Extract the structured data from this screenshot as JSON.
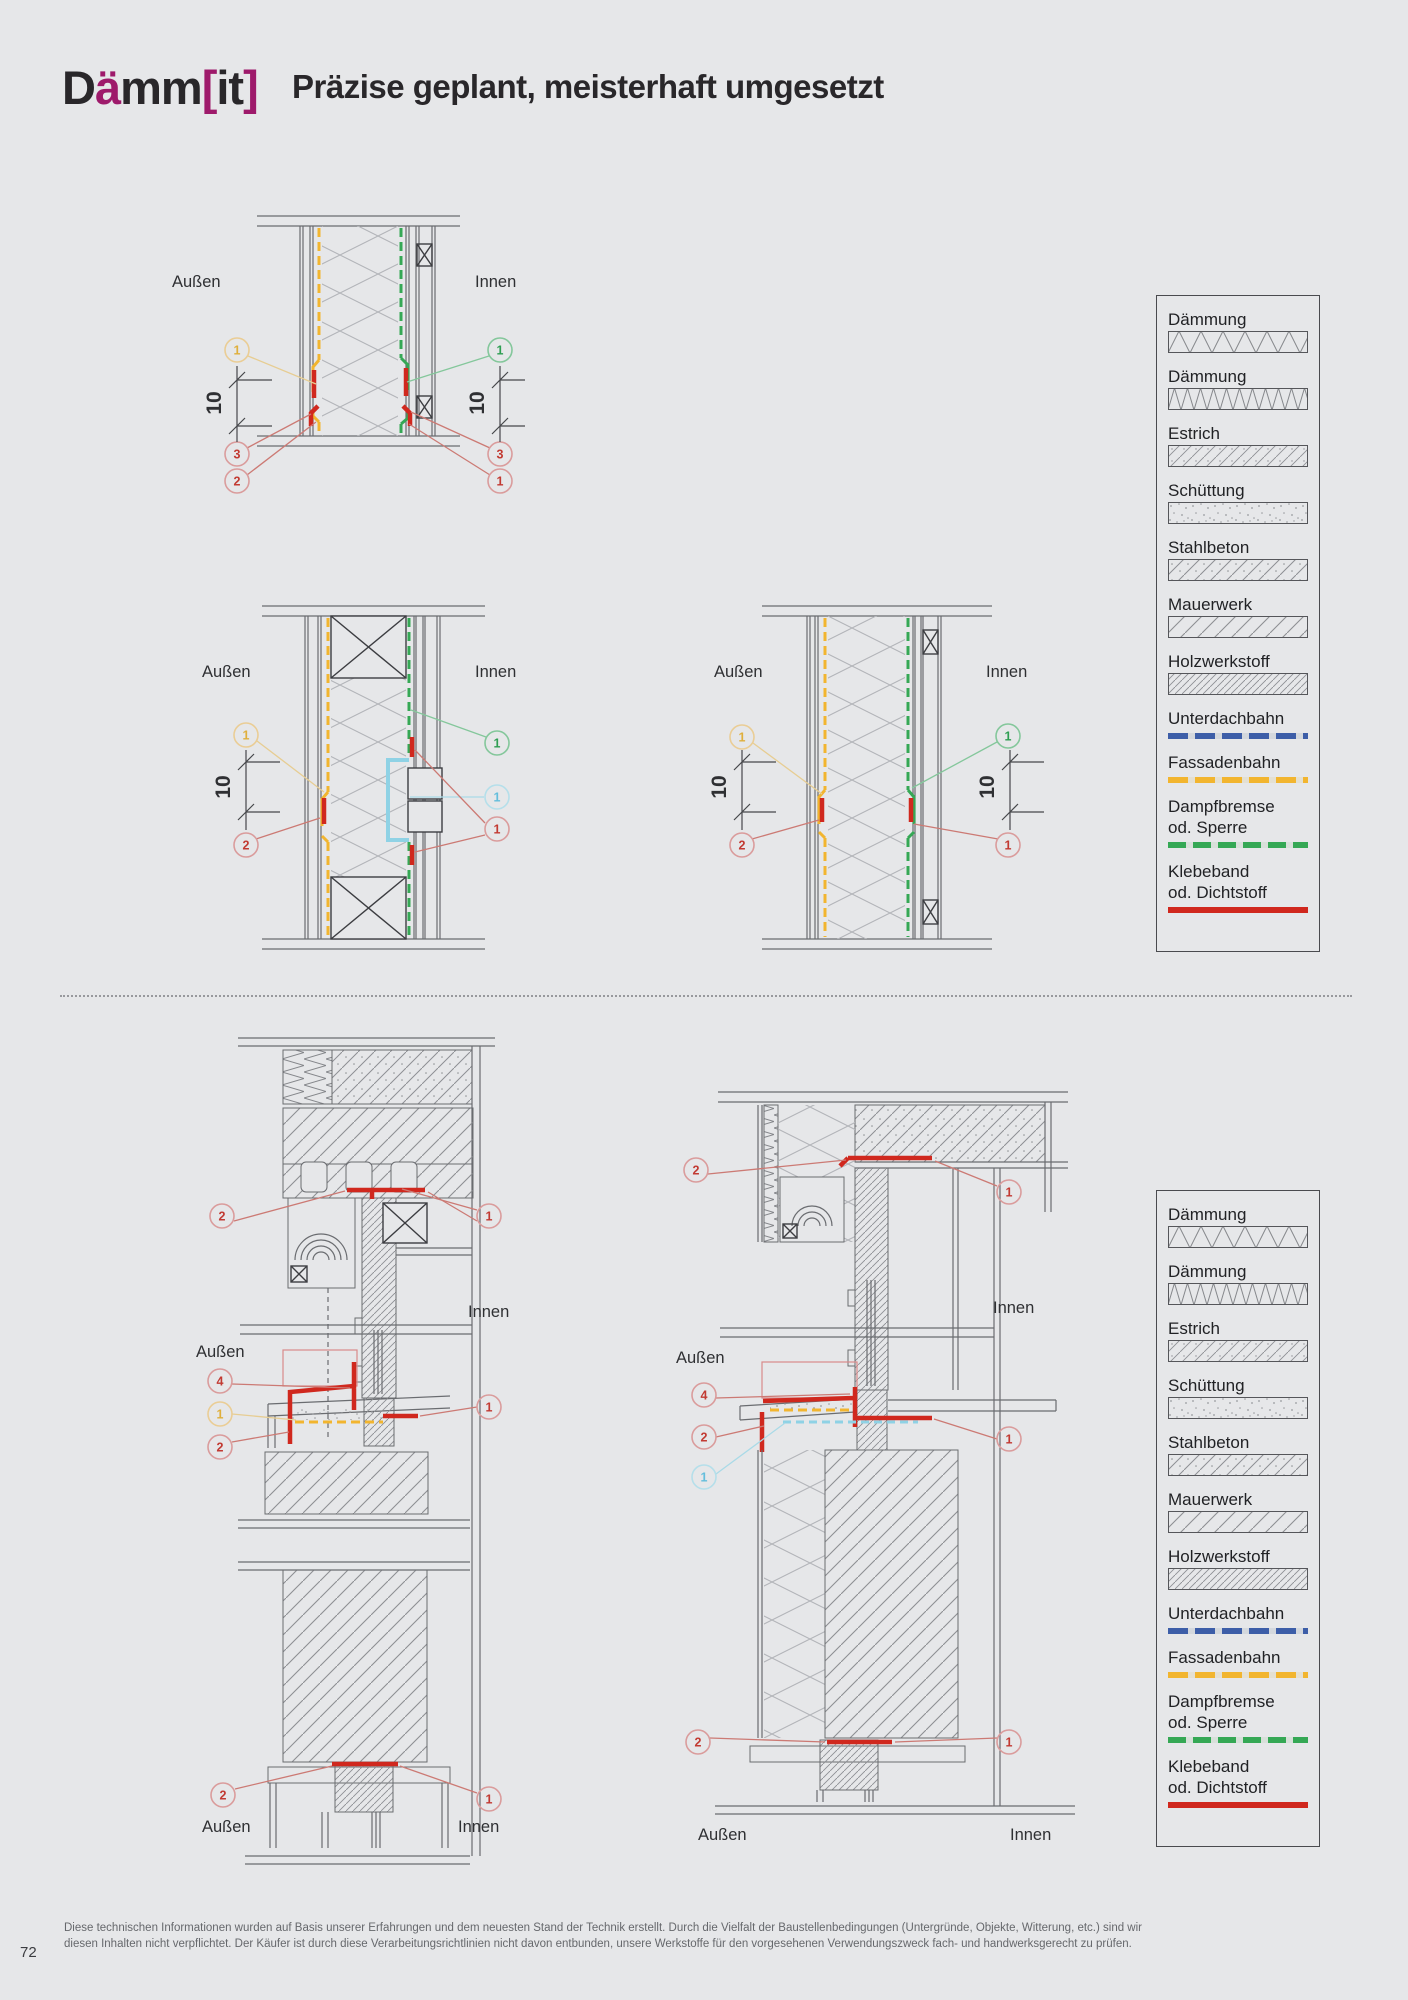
{
  "header": {
    "logo": {
      "d": "D",
      "auml": "ä",
      "mm": "mm",
      "bracket_open": "[",
      "it": "it",
      "bracket_close": "]"
    },
    "title": "Präzise geplant, meisterhaft umgesetzt"
  },
  "labels": {
    "aussen": "Außen",
    "innen": "Innen",
    "dim": "10"
  },
  "legend": {
    "items": [
      {
        "label": "Dämmung",
        "swatch": "insulation-batt-wide"
      },
      {
        "label": "Dämmung",
        "swatch": "insulation-batt-dense"
      },
      {
        "label": "Estrich",
        "swatch": "screed-hatch"
      },
      {
        "label": "Schüttung",
        "swatch": "loose-fill-stipple"
      },
      {
        "label": "Stahlbeton",
        "swatch": "reinforced-concrete-hatch"
      },
      {
        "label": "Mauerwerk",
        "swatch": "masonry-hatch"
      },
      {
        "label": "Holzwerkstoff",
        "swatch": "wood-panel-hatch"
      },
      {
        "label": "Unterdachbahn",
        "swatch": "membrane-blue-dashed"
      },
      {
        "label": "Fassadenbahn",
        "swatch": "membrane-yellow-dashed"
      },
      {
        "label": "Dampfbremse",
        "label2": "od. Sperre",
        "swatch": "membrane-green-dashed"
      },
      {
        "label": "Klebeband",
        "label2": "od. Dichtstoff",
        "swatch": "sealant-red-solid"
      }
    ]
  },
  "diagrams": {
    "d1": {
      "l": [
        "1",
        "3",
        "2"
      ],
      "r": [
        "1",
        "3",
        "1"
      ]
    },
    "d2": {
      "l": [
        "1",
        "2"
      ],
      "r": [
        "1",
        "1",
        "1"
      ]
    },
    "d3": {
      "l": [
        "1",
        "2"
      ],
      "r": [
        "1",
        "1"
      ]
    },
    "d4": {
      "head": [
        "2",
        "1"
      ],
      "sill": [
        "4",
        "1",
        "2",
        "1"
      ],
      "base": [
        "2",
        "1"
      ]
    },
    "d5": {
      "head": [
        "2",
        "1"
      ],
      "sill": [
        "4",
        "2",
        "1",
        "1"
      ],
      "base": [
        "2",
        "1"
      ]
    }
  },
  "colors": {
    "background": "#e6e7e9",
    "logo_magenta": "#9e1a6b",
    "membrane_yellow": "#f2b52f",
    "membrane_green": "#35a855",
    "membrane_blue": "#3d5ea8",
    "sealant_red": "#d0281e",
    "detail_cyan": "#8fd2e5"
  },
  "footer": {
    "line1": "Diese technischen Informationen wurden auf Basis unserer Erfahrungen und dem neuesten Stand der Technik erstellt. Durch die Vielfalt der Baustellenbedingungen (Untergründe, Objekte, Witterung, etc.) sind wir",
    "line2": "diesen Inhalten nicht verpflichtet. Der Käufer ist durch diese Verarbeitungsrichtlinien nicht davon entbunden, unsere Werkstoffe für den vorgesehenen Verwendungszweck fach- und handwerksgerecht zu prüfen.",
    "page_number": "72"
  }
}
